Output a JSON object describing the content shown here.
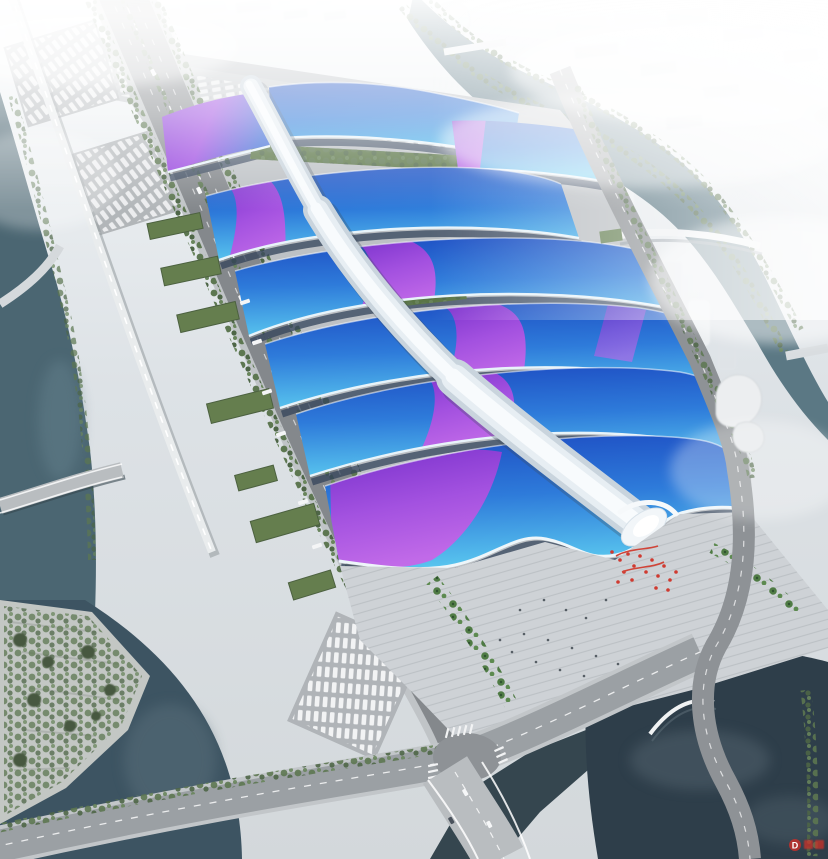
{
  "image": {
    "type": "aerial-architectural-rendering",
    "subject": "riverside exhibition and convention center complex",
    "description": "Bird's-eye rendering of a long exhibition complex: rows of wavy blue shell roofs crossed by a purple ribbon, a white serpentine central concourse spine ending in a sculpted white entrance crown, a stepped south plaza with palm trees and red banners, surrounded by boulevards, truck aprons, canals, waterfront parks and a hazy white city skyline."
  },
  "watermark": {
    "logo_text": "D",
    "color": "#c4302b"
  },
  "palette": {
    "haze": "#eef1f4",
    "pavement": "#c6cacd",
    "road_asphalt": "#85898d",
    "road_light": "#9ba0a4",
    "roof_blue_dark": "#1d4cc2",
    "roof_blue_mid": "#2e7bda",
    "roof_cyan": "#58c4ee",
    "ribbon_purple": "#7c2ecb",
    "ribbon_magenta": "#c766e8",
    "spine_white": "#f8fbfd",
    "green_tree": "#5d7751",
    "green_roof": "#657e4e",
    "water_river": "#4b6672",
    "water_pond": "#2e3e4a",
    "accent_red": "#cf3a30"
  }
}
